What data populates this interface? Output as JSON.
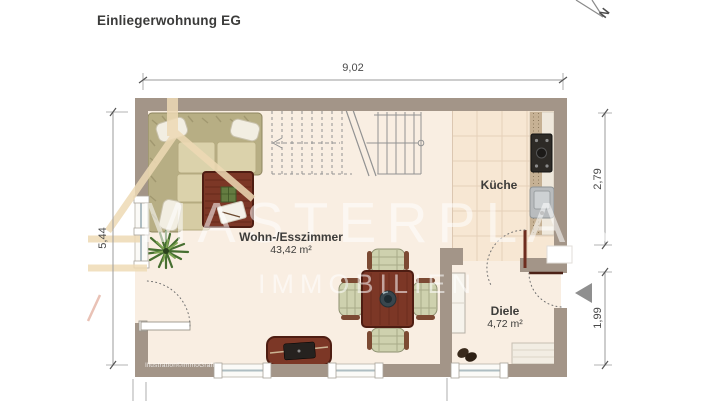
{
  "title": "Einliegerwohnung EG",
  "compass": {
    "label": "N"
  },
  "dimensions": {
    "width_total": "9,02",
    "height_left": "5,44",
    "right_upper": "2,79",
    "right_lower": "1,99"
  },
  "rooms": {
    "living": {
      "name": "Wohn-/Esszimmer",
      "area": "43,42 m²"
    },
    "kitchen": {
      "name": "Küche"
    },
    "hall": {
      "name": "Diele",
      "area": "4,72 m²"
    }
  },
  "watermark": {
    "line1": "MASTERPLAN",
    "line2": "IMMOBILIEN"
  },
  "credit": "Illustration©ImmoGrafik",
  "colors": {
    "wall": "#a39588",
    "floor": "#f9eee2",
    "kitchen_tiles": "#f7e7d3",
    "wood_furniture": "#7c3726",
    "sofa": "#b7ae84",
    "watermark_beige": "#eedab5",
    "dimension_text": "#4a4a4a",
    "entrance_arrow": "#8f8f8f"
  },
  "icons": [
    "north-arrow-icon",
    "entrance-arrow-icon",
    "corner-sofa",
    "coffee-table",
    "potted-plant",
    "staircase",
    "dining-set",
    "sideboard-tv",
    "kitchen-counter",
    "stove",
    "sink",
    "hall-cabinet",
    "hall-bench",
    "shoes",
    "window",
    "door-swing",
    "watermark-house"
  ]
}
